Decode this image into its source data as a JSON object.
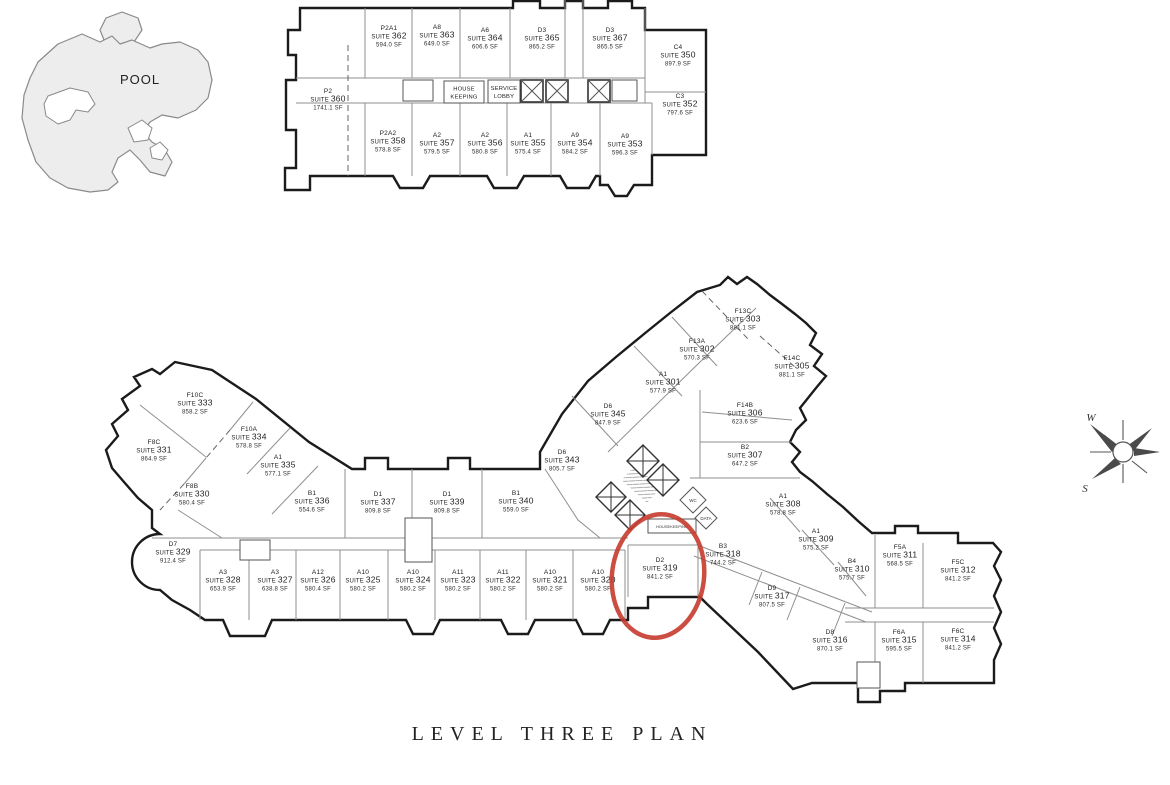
{
  "title": "LEVEL THREE PLAN",
  "pool_label": "POOL",
  "suite_word": "SUITE",
  "compass": {
    "w": "W",
    "s": "S"
  },
  "core": {
    "house_keeping": [
      "HOUSE",
      "KEEPING"
    ],
    "service_lobby": [
      "SERVICE",
      "LOBBY"
    ],
    "wc": "WC",
    "data": "DATA",
    "housekeeping": "HOUSEKEEPING"
  },
  "highlight": {
    "suite": "319",
    "color": "#c63b2e"
  },
  "upper_building": [
    {
      "unit": "P2",
      "suite": "360",
      "area": "1741.1 SF",
      "x": 328,
      "y": 100
    },
    {
      "unit": "P2A1",
      "suite": "362",
      "area": "594.0 SF",
      "x": 389,
      "y": 37
    },
    {
      "unit": "A8",
      "suite": "363",
      "area": "649.0 SF",
      "x": 437,
      "y": 36
    },
    {
      "unit": "A6",
      "suite": "364",
      "area": "606.6 SF",
      "x": 485,
      "y": 39
    },
    {
      "unit": "D3",
      "suite": "365",
      "area": "865.2 SF",
      "x": 542,
      "y": 39
    },
    {
      "unit": "D3",
      "suite": "367",
      "area": "865.5 SF",
      "x": 610,
      "y": 39
    },
    {
      "unit": "C4",
      "suite": "350",
      "area": "897.9 SF",
      "x": 678,
      "y": 56
    },
    {
      "unit": "C3",
      "suite": "352",
      "area": "797.6 SF",
      "x": 680,
      "y": 105
    },
    {
      "unit": "P2A2",
      "suite": "358",
      "area": "578.8 SF",
      "x": 388,
      "y": 142
    },
    {
      "unit": "A2",
      "suite": "357",
      "area": "579.5 SF",
      "x": 437,
      "y": 144
    },
    {
      "unit": "A2",
      "suite": "356",
      "area": "580.8 SF",
      "x": 485,
      "y": 144
    },
    {
      "unit": "A1",
      "suite": "355",
      "area": "575.4 SF",
      "x": 528,
      "y": 144
    },
    {
      "unit": "A9",
      "suite": "354",
      "area": "584.2 SF",
      "x": 575,
      "y": 144
    },
    {
      "unit": "A9",
      "suite": "353",
      "area": "596.3 SF",
      "x": 625,
      "y": 145
    }
  ],
  "main_building": [
    {
      "unit": "F10C",
      "suite": "333",
      "area": "858.2 SF",
      "x": 195,
      "y": 404
    },
    {
      "unit": "F10A",
      "suite": "334",
      "area": "578.8 SF",
      "x": 249,
      "y": 438
    },
    {
      "unit": "F8C",
      "suite": "331",
      "area": "864.9 SF",
      "x": 154,
      "y": 451
    },
    {
      "unit": "A1",
      "suite": "335",
      "area": "577.1 SF",
      "x": 278,
      "y": 466
    },
    {
      "unit": "F8B",
      "suite": "330",
      "area": "580.4 SF",
      "x": 192,
      "y": 495
    },
    {
      "unit": "B1",
      "suite": "336",
      "area": "554.6 SF",
      "x": 312,
      "y": 502
    },
    {
      "unit": "D1",
      "suite": "337",
      "area": "809.8 SF",
      "x": 378,
      "y": 503
    },
    {
      "unit": "D1",
      "suite": "339",
      "area": "809.8 SF",
      "x": 447,
      "y": 503
    },
    {
      "unit": "B1",
      "suite": "340",
      "area": "559.0 SF",
      "x": 516,
      "y": 502
    },
    {
      "unit": "D6",
      "suite": "343",
      "area": "805.7 SF",
      "x": 562,
      "y": 461
    },
    {
      "unit": "D6",
      "suite": "345",
      "area": "847.9 SF",
      "x": 608,
      "y": 415
    },
    {
      "unit": "A1",
      "suite": "301",
      "area": "577.9 SF",
      "x": 663,
      "y": 383
    },
    {
      "unit": "F13A",
      "suite": "302",
      "area": "570.3 SF",
      "x": 697,
      "y": 350
    },
    {
      "unit": "F13C",
      "suite": "303",
      "area": "881.1 SF",
      "x": 743,
      "y": 320
    },
    {
      "unit": "F14C",
      "suite": "305",
      "area": "881.1 SF",
      "x": 792,
      "y": 367
    },
    {
      "unit": "F14B",
      "suite": "306",
      "area": "623.6 SF",
      "x": 745,
      "y": 414
    },
    {
      "unit": "B2",
      "suite": "307",
      "area": "647.2 SF",
      "x": 745,
      "y": 456
    },
    {
      "unit": "A1",
      "suite": "308",
      "area": "578.8 SF",
      "x": 783,
      "y": 505
    },
    {
      "unit": "A1",
      "suite": "309",
      "area": "575.2 SF",
      "x": 816,
      "y": 540
    },
    {
      "unit": "B4",
      "suite": "310",
      "area": "575.7 SF",
      "x": 852,
      "y": 570
    },
    {
      "unit": "F5A",
      "suite": "311",
      "area": "568.5 SF",
      "x": 900,
      "y": 556
    },
    {
      "unit": "F5C",
      "suite": "312",
      "area": "841.2 SF",
      "x": 958,
      "y": 571
    },
    {
      "unit": "D7",
      "suite": "329",
      "area": "912.4 SF",
      "x": 173,
      "y": 553
    },
    {
      "unit": "A3",
      "suite": "328",
      "area": "653.9 SF",
      "x": 223,
      "y": 581
    },
    {
      "unit": "A3",
      "suite": "327",
      "area": "638.8 SF",
      "x": 275,
      "y": 581
    },
    {
      "unit": "A12",
      "suite": "326",
      "area": "580.4 SF",
      "x": 318,
      "y": 581
    },
    {
      "unit": "A10",
      "suite": "325",
      "area": "580.2 SF",
      "x": 363,
      "y": 581
    },
    {
      "unit": "A10",
      "suite": "324",
      "area": "580.2 SF",
      "x": 413,
      "y": 581
    },
    {
      "unit": "A11",
      "suite": "323",
      "area": "580.2 SF",
      "x": 458,
      "y": 581
    },
    {
      "unit": "A11",
      "suite": "322",
      "area": "580.2 SF",
      "x": 503,
      "y": 581
    },
    {
      "unit": "A10",
      "suite": "321",
      "area": "580.2 SF",
      "x": 550,
      "y": 581
    },
    {
      "unit": "A10",
      "suite": "320",
      "area": "580.2 SF",
      "x": 598,
      "y": 581
    },
    {
      "unit": "D2",
      "suite": "319",
      "area": "841.2 SF",
      "x": 660,
      "y": 569
    },
    {
      "unit": "B3",
      "suite": "318",
      "area": "744.2 SF",
      "x": 723,
      "y": 555
    },
    {
      "unit": "D9",
      "suite": "317",
      "area": "807.5 SF",
      "x": 772,
      "y": 597
    },
    {
      "unit": "D8",
      "suite": "316",
      "area": "870.1 SF",
      "x": 830,
      "y": 641
    },
    {
      "unit": "F6A",
      "suite": "315",
      "area": "595.5 SF",
      "x": 899,
      "y": 641
    },
    {
      "unit": "F6C",
      "suite": "314",
      "area": "841.2 SF",
      "x": 958,
      "y": 640
    }
  ]
}
